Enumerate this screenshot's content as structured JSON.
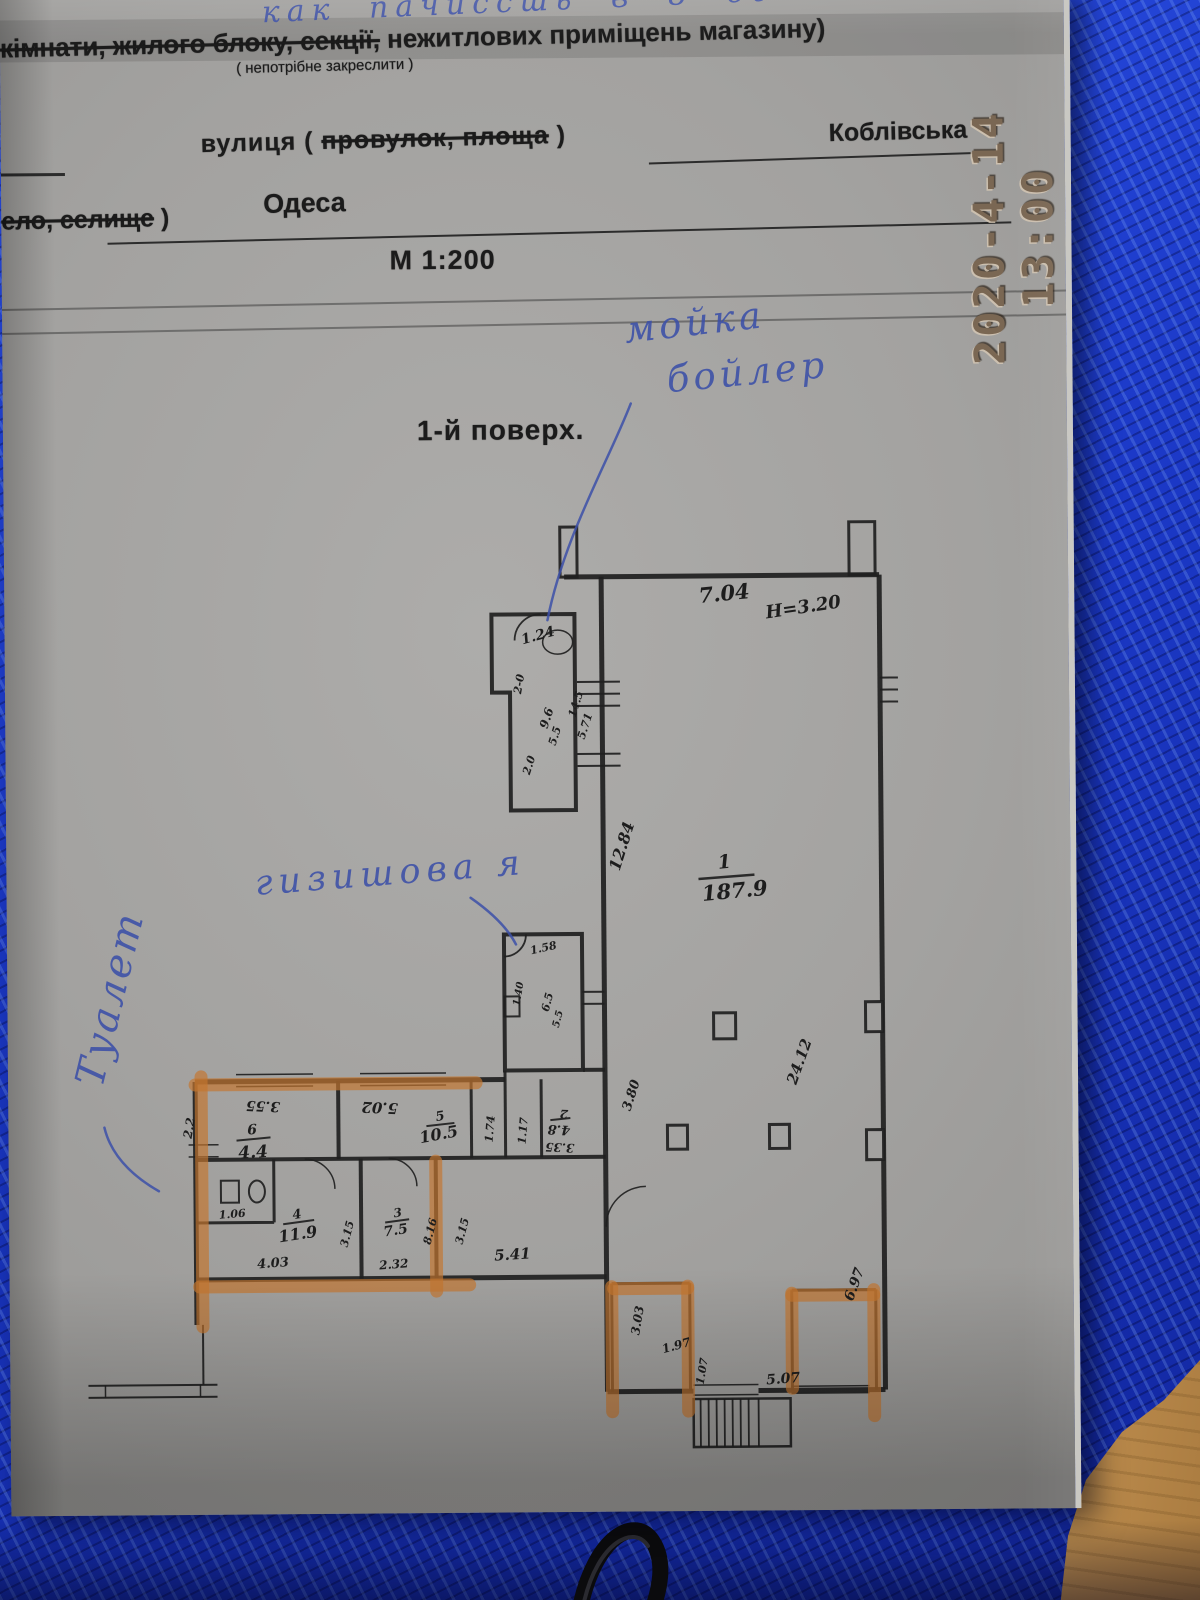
{
  "photo": {
    "timestamp": "2020-4-14 13:00",
    "handwriting": {
      "top_note": "как пачиссшь в 8 ог",
      "note_washer": "мойка",
      "note_boiler": "бойлер",
      "note_left": "Туалет",
      "note_room": "гизишова я"
    }
  },
  "document": {
    "header_struck": "кімнати, жилого блоку, секції,",
    "header_rest": " нежитлових приміщень магазину)",
    "header_hint": "( непотрібне закреслити )",
    "street_pre": "вулиця ( ",
    "street_struck": "провулок, площа",
    "street_post": " )",
    "street_value": "Коблівська",
    "settlement_struck": "ело, селище",
    "settlement_post": " )",
    "settlement_value": "Одеса",
    "scale": "М 1:200",
    "floor_title": "1-й поверх."
  },
  "plan": {
    "labels": [
      {
        "t": "7.04"
      },
      {
        "t": "Н=3.20"
      },
      {
        "t": "1.24"
      },
      {
        "t": "2-0"
      },
      {
        "t": "14.5"
      },
      {
        "t": "5.71"
      },
      {
        "t": "9.6"
      },
      {
        "t": "5.5"
      },
      {
        "t": "2.0"
      },
      {
        "t": "12.84"
      },
      {
        "t": "1"
      },
      {
        "t": "187.9"
      },
      {
        "t": "1.58"
      },
      {
        "t": "1.40"
      },
      {
        "t": "6.5"
      },
      {
        "t": "5.5"
      },
      {
        "t": "2.2"
      },
      {
        "t": "3.55"
      },
      {
        "t": "6"
      },
      {
        "t": "4.4"
      },
      {
        "t": "5.02"
      },
      {
        "t": "5"
      },
      {
        "t": "10.5"
      },
      {
        "t": "1.06"
      },
      {
        "t": "4"
      },
      {
        "t": "11.9"
      },
      {
        "t": "3.15"
      },
      {
        "t": "4.03"
      },
      {
        "t": "3"
      },
      {
        "t": "7.5"
      },
      {
        "t": "8.16"
      },
      {
        "t": "2.32"
      },
      {
        "t": "3.15"
      },
      {
        "t": "5.41"
      },
      {
        "t": "1.74"
      },
      {
        "t": "1.17"
      },
      {
        "t": "2"
      },
      {
        "t": "4.8"
      },
      {
        "t": "3.35"
      },
      {
        "t": "3.80"
      },
      {
        "t": "3.03"
      },
      {
        "t": "1.97"
      },
      {
        "t": "1.07"
      },
      {
        "t": "5.07"
      },
      {
        "t": "6.97"
      },
      {
        "t": "24.12"
      }
    ]
  }
}
